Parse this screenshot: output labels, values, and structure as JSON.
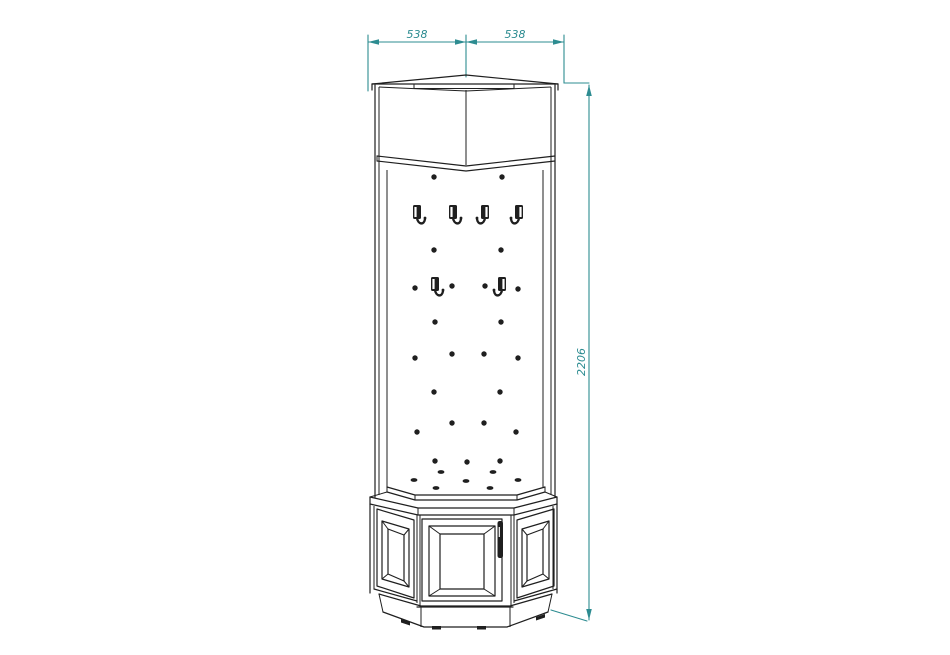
{
  "title": "corner-hall-stand-technical-drawing",
  "dimensions": {
    "width_left": "538",
    "width_right": "538",
    "height": "2206"
  },
  "colors": {
    "background": "#ffffff",
    "line": "#1f1f1f",
    "dimension": "#2d8c91"
  },
  "drawing": {
    "hooks": [
      {
        "x": 419,
        "y": 215,
        "dir": 1
      },
      {
        "x": 455,
        "y": 215,
        "dir": 1
      },
      {
        "x": 483,
        "y": 215,
        "dir": -1
      },
      {
        "x": 517,
        "y": 215,
        "dir": -1
      },
      {
        "x": 437,
        "y": 287,
        "dir": 1
      },
      {
        "x": 500,
        "y": 287,
        "dir": -1
      }
    ],
    "holes": [
      [
        434,
        177,
        0
      ],
      [
        502,
        177,
        0
      ],
      [
        434,
        250,
        0
      ],
      [
        501,
        250,
        0
      ],
      [
        415,
        288,
        0
      ],
      [
        452,
        286,
        0
      ],
      [
        485,
        286,
        0
      ],
      [
        518,
        289,
        0
      ],
      [
        435,
        322,
        0
      ],
      [
        501,
        322,
        0
      ],
      [
        415,
        358,
        0
      ],
      [
        452,
        354,
        0
      ],
      [
        484,
        354,
        0
      ],
      [
        518,
        358,
        0
      ],
      [
        434,
        392,
        0
      ],
      [
        500,
        392,
        0
      ],
      [
        417,
        432,
        0
      ],
      [
        452,
        423,
        0
      ],
      [
        484,
        423,
        0
      ],
      [
        516,
        432,
        0
      ],
      [
        435,
        461,
        0
      ],
      [
        467,
        462,
        0
      ],
      [
        500,
        461,
        0
      ],
      [
        441,
        472,
        1
      ],
      [
        493,
        472,
        1
      ],
      [
        414,
        480,
        1
      ],
      [
        466,
        481,
        1
      ],
      [
        518,
        480,
        1
      ],
      [
        436,
        488,
        1
      ],
      [
        490,
        488,
        1
      ]
    ]
  }
}
